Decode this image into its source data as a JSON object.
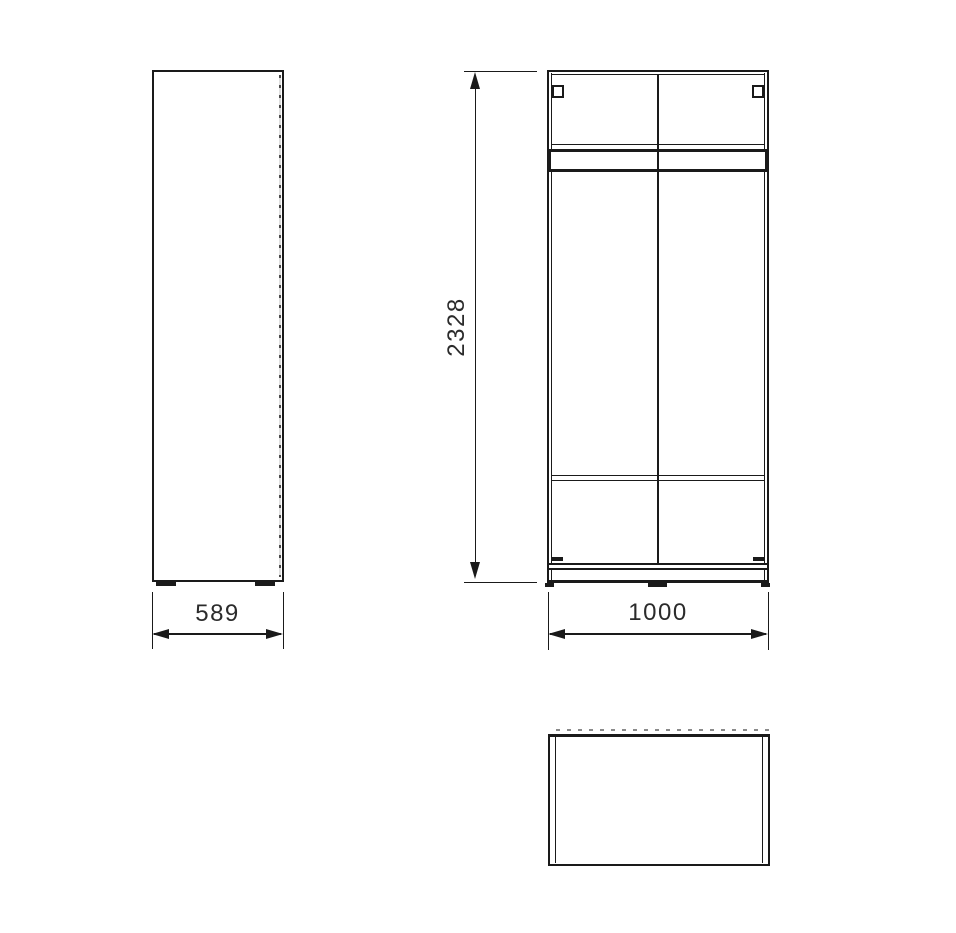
{
  "colors": {
    "background": "#ffffff",
    "line": "#1a1a1a",
    "dimension_text": "#2b2b2b",
    "hidden_edge_dash": "#4a4a4a"
  },
  "dimensions": {
    "depth": {
      "value": "589",
      "orientation": "horizontal",
      "applies_to": "side-view"
    },
    "height": {
      "value": "2328",
      "orientation": "vertical",
      "applies_to": "front-view"
    },
    "width": {
      "value": "1000",
      "orientation": "horizontal",
      "applies_to": "front-view"
    }
  },
  "icons": {
    "arrowheads": [
      "arrow-left-icon",
      "arrow-right-icon",
      "arrow-up-icon",
      "arrow-down-icon"
    ]
  }
}
